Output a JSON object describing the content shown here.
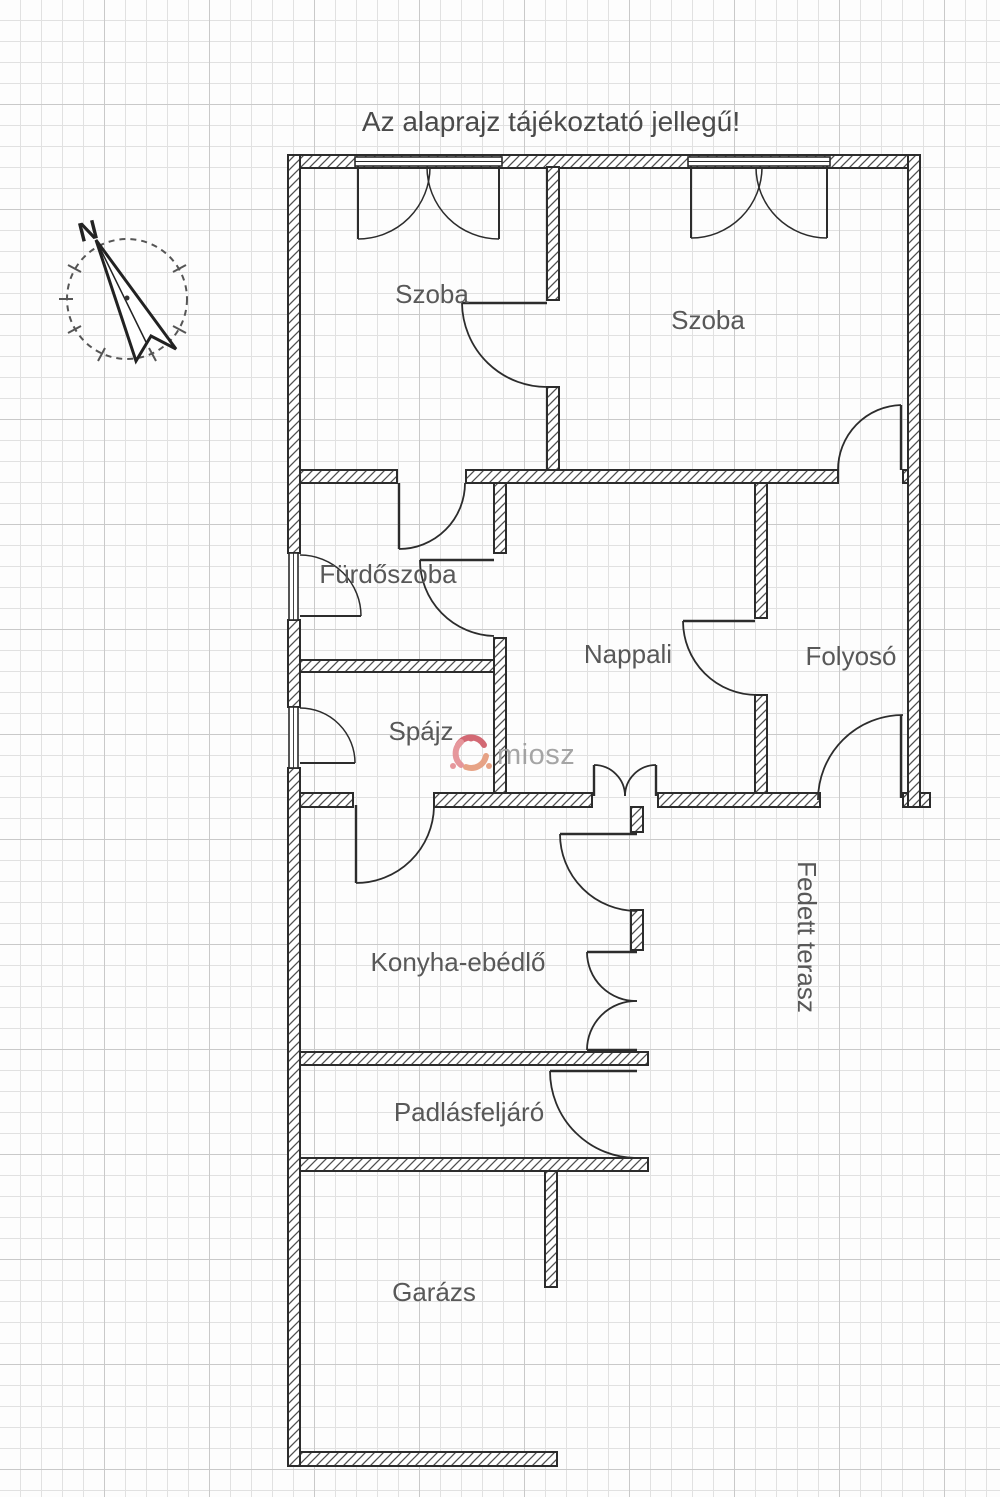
{
  "title": "Az alaprajz tájékoztató jellegű!",
  "compass": {
    "north_label": "N"
  },
  "watermark": {
    "text": "miosz"
  },
  "rooms": {
    "szoba1": {
      "label": "Szoba"
    },
    "szoba2": {
      "label": "Szoba"
    },
    "furdoszoba": {
      "label": "Fürdőszoba"
    },
    "nappali": {
      "label": "Nappali"
    },
    "folyoso": {
      "label": "Folyosó"
    },
    "spajz": {
      "label": "Spájz"
    },
    "konyha_ebedlo": {
      "label": "Konyha-ebédlő"
    },
    "fedett_terasz": {
      "label": "Fedett terasz"
    },
    "padlasfeljaro": {
      "label": "Padlásfeljáró"
    },
    "garazs": {
      "label": "Garázs"
    }
  },
  "colors": {
    "wall_line": "#2c2c2c",
    "room_label": "#585858",
    "grid_minor": "#e1e1e1",
    "grid_major": "#c9c9c9",
    "watermark_text": "#9c9c9c",
    "watermark_red": "#cf5a66",
    "watermark_salmon": "#e59a7a",
    "watermark_pink": "#e48d92"
  }
}
